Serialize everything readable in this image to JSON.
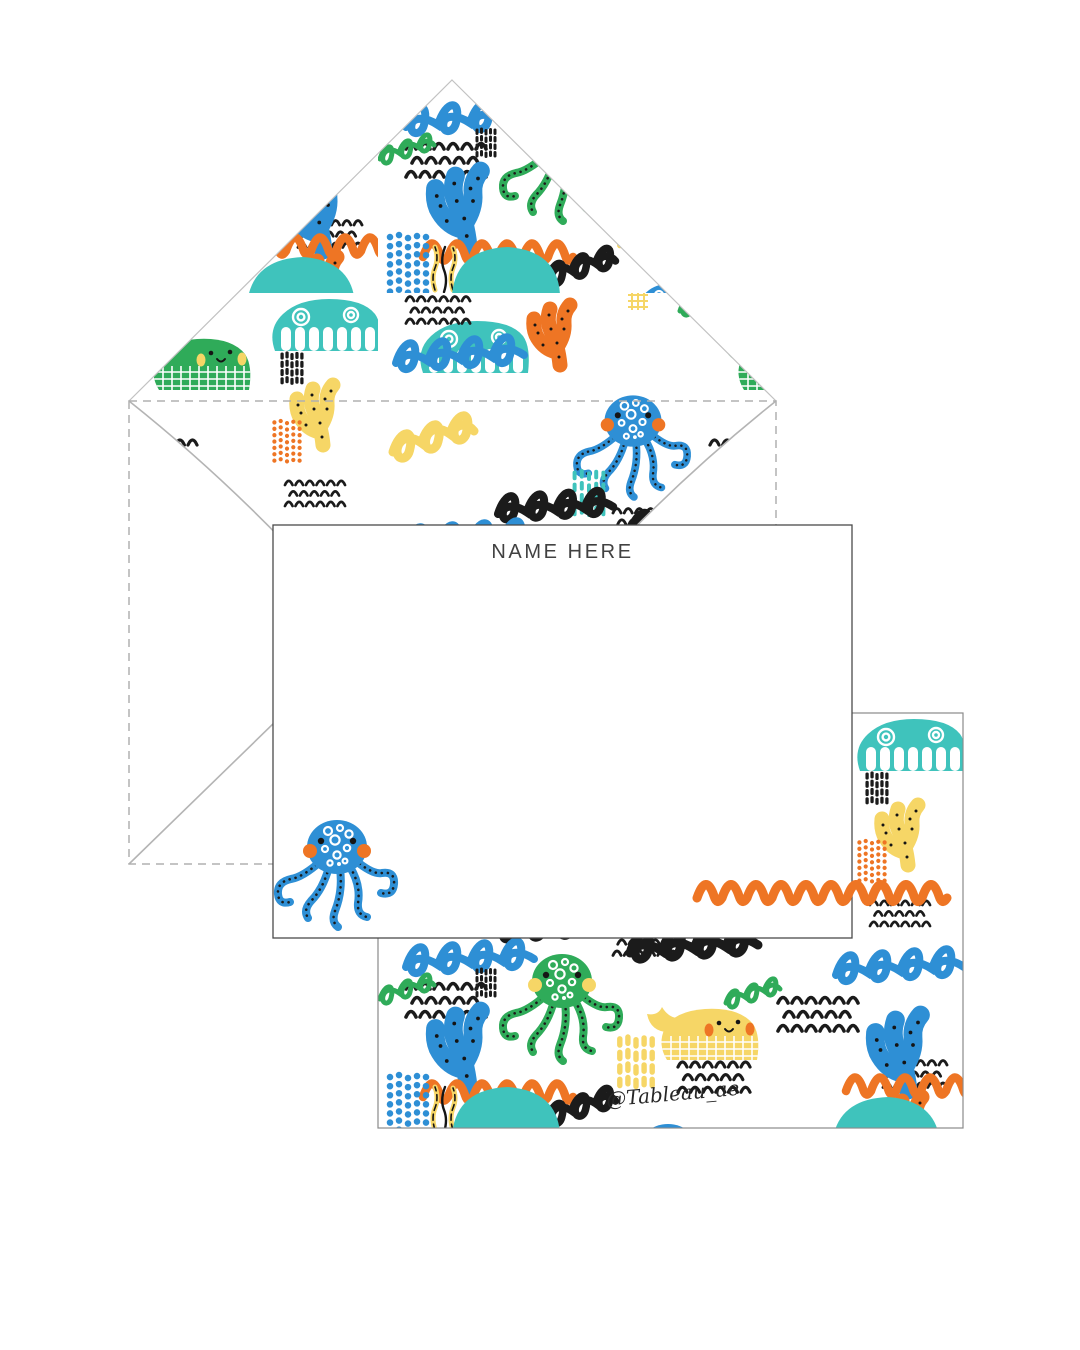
{
  "product": {
    "front_card": {
      "title": "NAME HERE"
    },
    "back_card": {
      "watermark": "@Tableau_ae"
    }
  },
  "palette": {
    "blue": "#2E8FD5",
    "teal": "#3FC3BC",
    "green": "#2FAB59",
    "yellow": "#F6D666",
    "orange": "#EE7524",
    "ink": "#1B1B1B",
    "envelope-line": "#B3B3B3",
    "card-line": "#4A4A4A",
    "title-text": "#414141"
  },
  "motifs": [
    "blue-octopus",
    "green-octopus",
    "teal-whale",
    "green-whale",
    "yellow-duck-whale",
    "orange-coral",
    "yellow-coral",
    "blue-coral",
    "orange-wave-squiggle",
    "black-loop-squiggle",
    "blue-loop-squiggle",
    "green-loop-squiggle",
    "black-arc-rows",
    "dash-patch",
    "bead-patch",
    "seaweed",
    "teal-blob",
    "yellow-grid-bit"
  ]
}
